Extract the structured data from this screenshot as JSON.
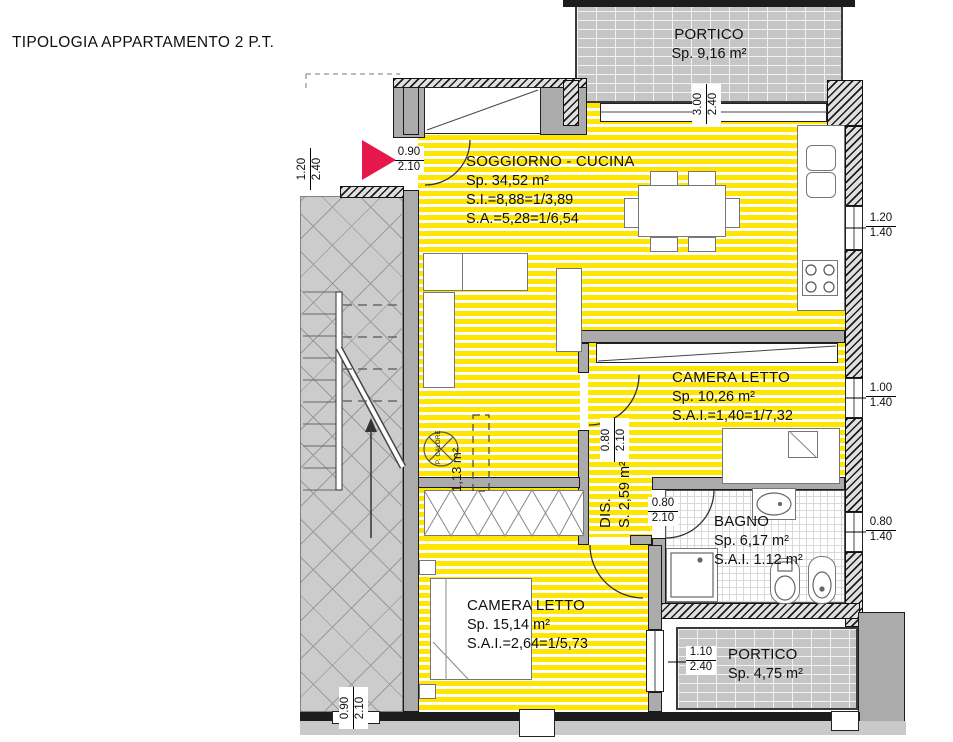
{
  "title": "TIPOLOGIA APPARTAMENTO 2 P.T.",
  "colors": {
    "floor_stripe": "#ffe600",
    "entrance_arrow": "#e8174b",
    "wall_gray": "#ababab",
    "portico_fill": "#c6c6c6"
  },
  "rooms": {
    "soggiorno": {
      "name": "SOGGIORNO - CUCINA",
      "area": "Sp. 34,52 m²",
      "si": "S.I.=8,88=1/3,89",
      "sa": "S.A.=5,28=1/6,54"
    },
    "camera1": {
      "name": "CAMERA LETTO",
      "area": "Sp. 10,26 m²",
      "sai": "S.A.I.=1,40=1/7,32"
    },
    "bagno": {
      "name": "BAGNO",
      "area": "Sp. 6,17 m²",
      "sai": "S.A.I. 1.12 m²"
    },
    "camera2": {
      "name": "CAMERA LETTO",
      "area": "Sp. 15,14 m²",
      "sai": "S.A.I.=2,64=1/5,73"
    },
    "portico_top": {
      "name": "PORTICO",
      "area": "Sp. 9,16 m²"
    },
    "portico_bottom": {
      "name": "PORTICO",
      "area": "Sp. 4,75 m²"
    },
    "disimpegno": {
      "name": "DIS.",
      "area": "S. 2,59 m²"
    },
    "ripostiglio": {
      "area": "1,13 m²"
    },
    "heat_point": {
      "label": "P. CALORE"
    }
  },
  "dimensions": [
    {
      "id": "portico-top-window",
      "top": "3.00",
      "bottom": "2.40"
    },
    {
      "id": "left-window",
      "top": "1.20",
      "bottom": "2.40"
    },
    {
      "id": "entry-door",
      "top": "0.90",
      "bottom": "2.10"
    },
    {
      "id": "kitchen-window",
      "top": "1.20",
      "bottom": "1.40"
    },
    {
      "id": "camera1-window",
      "top": "1.00",
      "bottom": "1.40"
    },
    {
      "id": "bagno-window",
      "top": "0.80",
      "bottom": "1.40"
    },
    {
      "id": "camera1-door",
      "top": "0.80",
      "bottom": "2.10"
    },
    {
      "id": "bagno-door",
      "top": "0.80",
      "bottom": "2.10"
    },
    {
      "id": "portico-bottom-door",
      "top": "1.10",
      "bottom": "2.40"
    },
    {
      "id": "bottom-left-door",
      "top": "0.90",
      "bottom": "2.10"
    }
  ]
}
